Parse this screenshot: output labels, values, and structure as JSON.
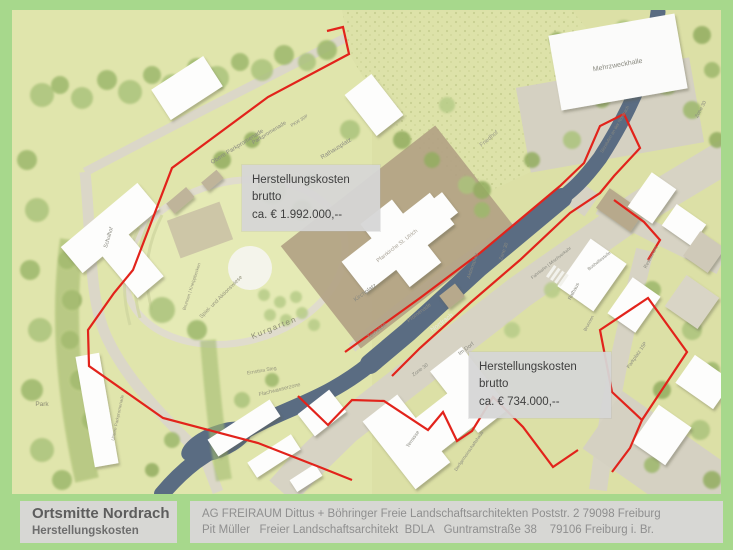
{
  "colors": {
    "frame_green": "#a7d88c",
    "map_base": "#dce0a6",
    "river_blue": "#5a6c82",
    "boundary_red": "#e2231b",
    "plaza_tan": "#b2a284",
    "road_gray": "#d7d3c4",
    "label_box_gray": "#d6d6d6"
  },
  "annotations": [
    {
      "line1": "Herstellungskosten",
      "line2": "brutto",
      "line3": "ca. € 1.992.000,--"
    },
    {
      "line1": "Herstellungskosten",
      "line2": "brutto",
      "line3": "ca. € 734.000,--"
    }
  ],
  "footer": {
    "title": "Ortsmitte Nordrach",
    "subtitle": "Herstellungskosten",
    "credit_line1": "AG FREIRAUM Dittus + Böhringer Freie Landschaftsarchitekten Poststr. 2 79098 Freiburg",
    "credit_line2": "Pit Müller   Freier Landschaftsarchitekt  BDLA   Guntramstraße 38    79106 Freiburg i. Br."
  },
  "map": {
    "labels": [
      {
        "text": "Mehrzweckhalle",
        "x": 606,
        "y": 57,
        "rot": -10,
        "size": 7,
        "color": "#8a8a80"
      },
      {
        "text": "Friedhof",
        "x": 478,
        "y": 130,
        "rot": -40,
        "size": 6,
        "color": "#9a9a88"
      },
      {
        "text": "Obere Parkpromenade",
        "x": 226,
        "y": 138,
        "rot": -32,
        "size": 6,
        "color": "#8a8a80"
      },
      {
        "text": "Parkpromenade",
        "x": 258,
        "y": 124,
        "rot": -32,
        "size": 5.5,
        "color": "#8a8a80"
      },
      {
        "text": "Rathausplatz",
        "x": 325,
        "y": 140,
        "rot": -32,
        "size": 6,
        "color": "#8a8a80"
      },
      {
        "text": "PKW 30P",
        "x": 288,
        "y": 112,
        "rot": -32,
        "size": 4.5,
        "color": "#8a8a80"
      },
      {
        "text": "Pfarrkirche St. Ulrich",
        "x": 386,
        "y": 237,
        "rot": -38,
        "size": 5.5,
        "color": "#a8a296"
      },
      {
        "text": "Kirchplatz",
        "x": 354,
        "y": 284,
        "rot": -36,
        "size": 6,
        "color": "#8a8a80"
      },
      {
        "text": "Kurgarten",
        "x": 263,
        "y": 320,
        "rot": -22,
        "size": 8,
        "color": "#8c8c74",
        "ls": 1.5
      },
      {
        "text": "Spiel- und Aktionswiese",
        "x": 210,
        "y": 288,
        "rot": -45,
        "size": 5.5,
        "color": "#95957e"
      },
      {
        "text": "Brunnen | Kneippbecken",
        "x": 181,
        "y": 277,
        "rot": -72,
        "size": 4.5,
        "color": "#95957e"
      },
      {
        "text": "Terrasse",
        "x": 366,
        "y": 322,
        "rot": -38,
        "size": 6,
        "color": "#8a8a80"
      },
      {
        "text": "Promenade",
        "x": 408,
        "y": 304,
        "rot": -37,
        "size": 5.5,
        "color": "#8a8a80"
      },
      {
        "text": "Aktionsplatz",
        "x": 462,
        "y": 256,
        "rot": -72,
        "size": 5,
        "color": "#8a8a80"
      },
      {
        "text": "Nordrach",
        "x": 431,
        "y": 314,
        "rot": -37,
        "size": 6.5,
        "color": "#e9e9e2"
      },
      {
        "text": "Im Dorf",
        "x": 455,
        "y": 340,
        "rot": -37,
        "size": 5.5,
        "color": "#8a8a80"
      },
      {
        "text": "Zone 30",
        "x": 409,
        "y": 361,
        "rot": -37,
        "size": 5,
        "color": "#8a8a80"
      },
      {
        "text": "Zone 30",
        "x": 493,
        "y": 242,
        "rot": -70,
        "size": 5,
        "color": "#8a8a80"
      },
      {
        "text": "Zone 30",
        "x": 690,
        "y": 100,
        "rot": -62,
        "size": 5,
        "color": "#8a8a80"
      },
      {
        "text": "Sitzstufen an der Nordrach",
        "x": 604,
        "y": 120,
        "rot": -60,
        "size": 4.5,
        "color": "#8a8a80"
      },
      {
        "text": "Fahrbahn | Mischverkehr",
        "x": 540,
        "y": 254,
        "rot": -38,
        "size": 4.5,
        "color": "#8a8a80"
      },
      {
        "text": "Flachwasserzone",
        "x": 268,
        "y": 381,
        "rot": -14,
        "size": 5.5,
        "color": "#95957e"
      },
      {
        "text": "Ernstina Steg",
        "x": 250,
        "y": 362,
        "rot": -10,
        "size": 5,
        "color": "#95957e"
      },
      {
        "text": "Park",
        "x": 30,
        "y": 396,
        "rot": 0,
        "size": 6.5,
        "color": "#8c8c74"
      },
      {
        "text": "Schulhof",
        "x": 98,
        "y": 228,
        "rot": -73,
        "size": 5.5,
        "color": "#8a8a80"
      },
      {
        "text": "Rathaus",
        "x": 563,
        "y": 282,
        "rot": -62,
        "size": 5,
        "color": "#8a8a80"
      },
      {
        "text": "Brunnen",
        "x": 578,
        "y": 314,
        "rot": -62,
        "size": 4.5,
        "color": "#8a8a80"
      },
      {
        "text": "Bushaltestelle",
        "x": 588,
        "y": 252,
        "rot": -38,
        "size": 4.5,
        "color": "#8a8a80"
      },
      {
        "text": "Parkplatz 15P",
        "x": 626,
        "y": 346,
        "rot": -55,
        "size": 5,
        "color": "#8a8a80"
      },
      {
        "text": "Restaurant",
        "x": 640,
        "y": 248,
        "rot": -62,
        "size": 5,
        "color": "#8a8a80"
      },
      {
        "text": "Dorfgemeinschaftshaus",
        "x": 458,
        "y": 442,
        "rot": -55,
        "size": 4.5,
        "color": "#8a8a80"
      },
      {
        "text": "Terrasse",
        "x": 402,
        "y": 430,
        "rot": -55,
        "size": 5,
        "color": "#8a8a80"
      },
      {
        "text": "Untere Parkpromenade",
        "x": 107,
        "y": 408,
        "rot": -78,
        "size": 4.5,
        "color": "#95957e"
      }
    ]
  }
}
